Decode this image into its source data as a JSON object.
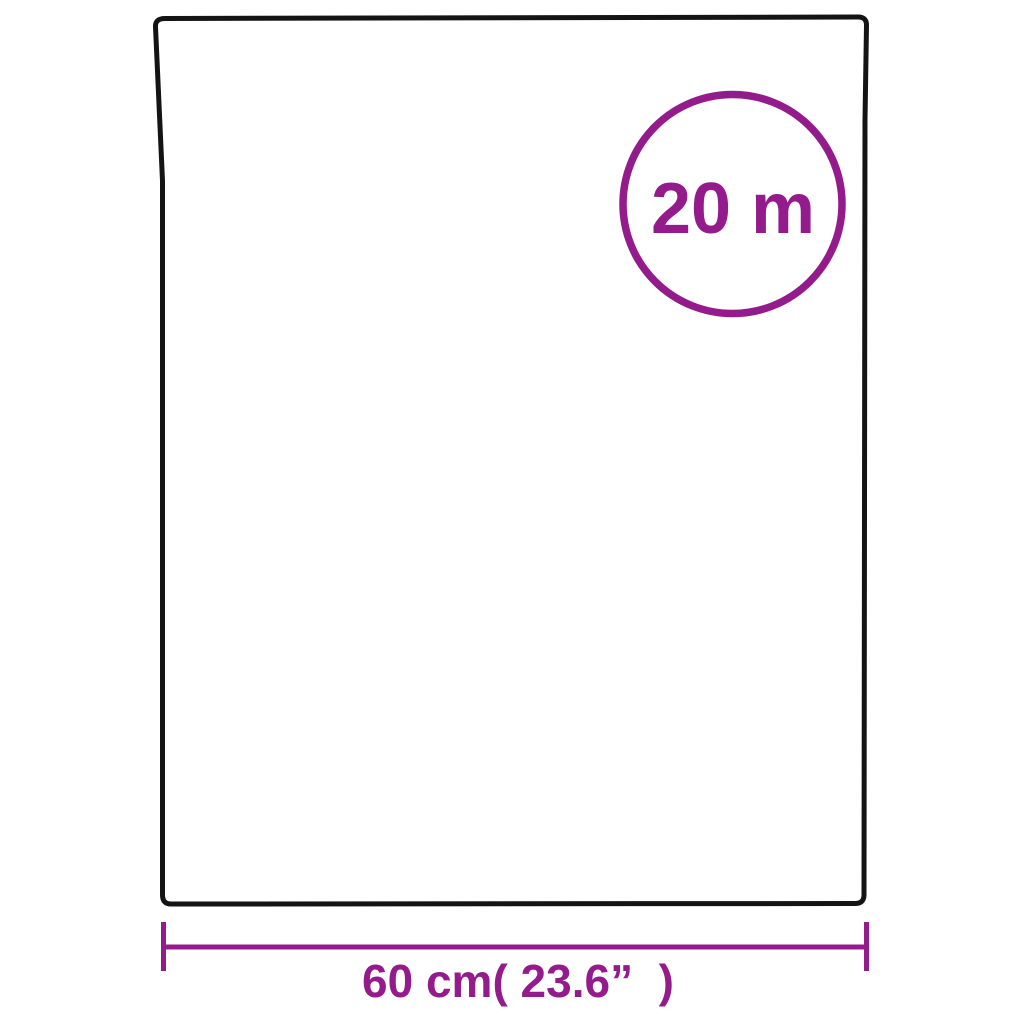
{
  "colors": {
    "accent": "#941b8c",
    "outline": "#141414",
    "background": "#ffffff"
  },
  "diagram": {
    "title": "product-roll-dimensions",
    "roll_length_badge": "20 m",
    "width_dimension_label": "60 cm( 23.6”  )"
  }
}
